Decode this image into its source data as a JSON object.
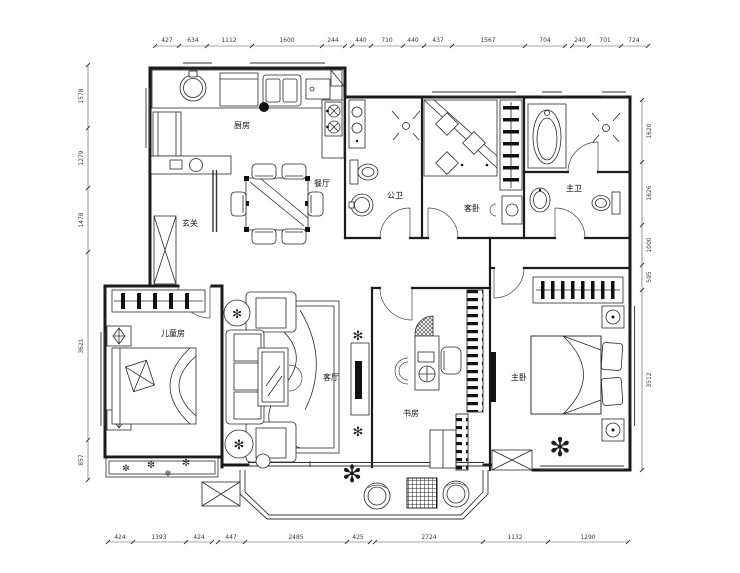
{
  "rooms": {
    "kitchen": "厨房",
    "dining": "餐厅",
    "entry": "玄关",
    "guest_bath": "公卫",
    "guest_bedroom": "客卧",
    "master_bath": "主卫",
    "kids_room": "儿童房",
    "living": "客厅",
    "study": "书房",
    "master_bedroom": "主卧"
  },
  "dims": {
    "top": [
      "427",
      "634",
      "1112",
      "1600",
      "244",
      "440",
      "710",
      "440",
      "437",
      "1567",
      "704",
      "240",
      "701",
      "724"
    ],
    "left": [
      "1578",
      "1279",
      "1478",
      "3621",
      "857"
    ],
    "right": [
      "1620",
      "1626",
      "1000",
      "595",
      "3512"
    ],
    "bottom": [
      "424",
      "1393",
      "424",
      "447",
      "2485",
      "425",
      "2724",
      "1132",
      "1290"
    ]
  },
  "icons": {
    "plant": "✻",
    "flower": "✼"
  }
}
